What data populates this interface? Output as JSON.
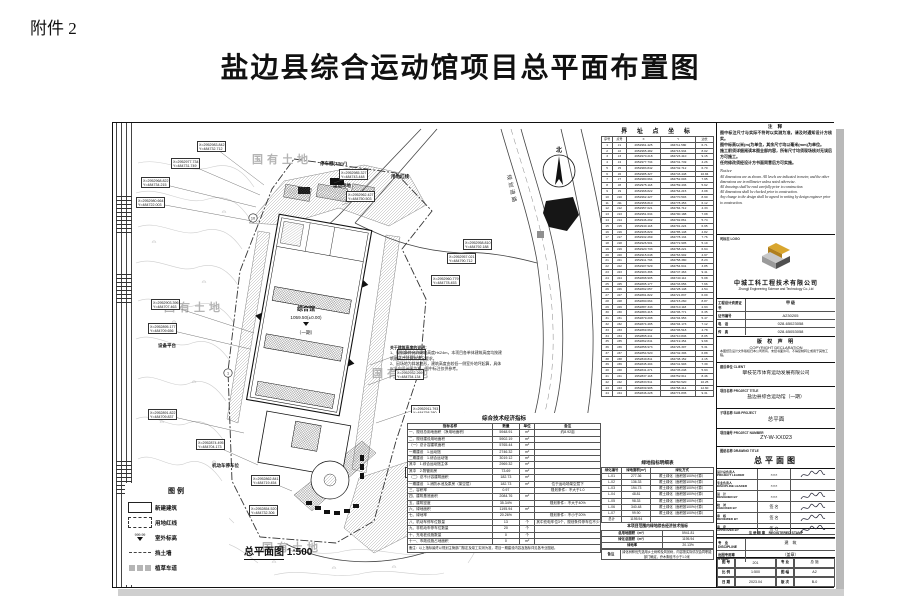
{
  "page": {
    "attachment_label": "附件 2",
    "title": "盐边县综合运动馆项目总平面布置图"
  },
  "drawing": {
    "scale_label": "总平面图",
    "scale_value": "1:500",
    "north_label": "北",
    "road_label": "规划道路",
    "land_labels": [
      "国有土地",
      "国有土地",
      "国有土地",
      "国有土地"
    ],
    "building": {
      "name": "综合馆",
      "elevation": "1059.50(±0.00)",
      "phase": "（一期）"
    },
    "point_markers": [
      "10",
      "1"
    ],
    "labels": {
      "sports_field": "运动场地",
      "red_line": "用地红线",
      "shed": "停车棚(33m²)",
      "platform": "设备平台",
      "parking": "机动车停车位"
    },
    "note_block": {
      "title": "关于建筑高度的说明：",
      "lines": [
        "1、规划条件允许建筑高度H≤24m，本项目各单体建筑高度均按建筑最高点计算并满足要求。",
        "2、因场地为斜坡地形，建筑高度由较低一侧室外地坪起算，具体以竖向设计图为准，图中标注仅供参考。"
      ]
    },
    "callouts": [
      {
        "x": "X=2952983.842",
        "y": "Y=484732.712"
      },
      {
        "x": "X=2952977.734",
        "y": "Y=484731.749"
      },
      {
        "x": "X=2952968.822",
        "y": "Y=484734.215"
      },
      {
        "x": "X=2952980.664",
        "y": "Y=484722.003"
      },
      {
        "x": "X=2952985.327",
        "y": "Y=484743.448"
      },
      {
        "x": "X=2952962.427",
        "y": "Y=484750.503"
      },
      {
        "x": "X=2952958.810",
        "y": "Y=484792.188"
      },
      {
        "x": "X=2952957.021",
        "y": "Y=484790.712"
      },
      {
        "x": "X=2952960.779",
        "y": "Y=484778.453"
      },
      {
        "x": "X=2952935.829",
        "y": "Y=484755.148"
      },
      {
        "x": "X=2952932.269",
        "y": "Y=484754.134"
      },
      {
        "x": "X=2952911.793",
        "y": "Y=484758.380"
      },
      {
        "x": "X=2952907.529",
        "y": "Y=484754.641"
      },
      {
        "x": "X=2952892.057",
        "y": "Y=484748.148"
      },
      {
        "x": "X=2952903.396",
        "y": "Y=484707.463"
      },
      {
        "x": "X=2952895.177",
        "y": "Y=484709.656"
      },
      {
        "x": "X=2952891.822",
        "y": "Y=484709.837"
      },
      {
        "x": "X=2952874.495",
        "y": "Y=484704.173"
      },
      {
        "x": "X=2952862.841",
        "y": "Y=484719.454"
      },
      {
        "x": "X=2952854.520",
        "y": "Y=484732.306"
      },
      {
        "x": "X=2952841.271",
        "y": "Y=484745.248"
      },
      {
        "x": "X=2952833.511",
        "y": "Y=484760.520"
      }
    ]
  },
  "legend": {
    "title": "图例",
    "items": [
      {
        "label": "新建建筑",
        "swatch": "building"
      },
      {
        "label": "用地红线",
        "swatch": "redline"
      },
      {
        "label": "室外标高",
        "swatch": "elevation",
        "sample": "999.99"
      },
      {
        "label": "挡土墙",
        "swatch": "wall"
      },
      {
        "label": "植草车道",
        "swatch": "grass"
      }
    ]
  },
  "boundary_table": {
    "title": "界 址 点 坐 标",
    "headers": [
      "序号",
      "点号",
      "X",
      "Y",
      "边长"
    ],
    "rows": [
      [
        "1",
        "J1",
        "2952961.425",
        "484711.580",
        "6.71"
      ],
      [
        "2",
        "J2",
        "2952965.482",
        "484716.934",
        "8.02"
      ],
      [
        "3",
        "J3",
        "2952970.218",
        "484723.410",
        "9.15"
      ],
      [
        "4",
        "J4",
        "2952977.734",
        "484731.749",
        "4.26"
      ],
      [
        "5",
        "J5",
        "2952983.842",
        "484732.712",
        "6.70"
      ],
      [
        "6",
        "J6",
        "2952985.327",
        "484743.448",
        "10.84"
      ],
      [
        "7",
        "J7",
        "2952980.664",
        "484752.003",
        "7.95"
      ],
      [
        "8",
        "J8",
        "2952975.118",
        "484759.436",
        "5.62"
      ],
      [
        "9",
        "J9",
        "2952968.822",
        "484764.215",
        "3.08"
      ],
      [
        "10",
        "J10",
        "2952962.427",
        "484770.503",
        "8.90"
      ],
      [
        "11",
        "J11",
        "2952958.810",
        "484778.453",
        "6.12"
      ],
      [
        "12",
        "J12",
        "2952957.021",
        "484784.712",
        "4.33"
      ],
      [
        "13",
        "J13",
        "2952951.634",
        "484790.188",
        "7.08"
      ],
      [
        "14",
        "J14",
        "2952946.292",
        "484792.861",
        "5.74"
      ],
      [
        "15",
        "J15",
        "2952940.118",
        "484791.224",
        "6.95"
      ],
      [
        "16",
        "J16",
        "2952935.829",
        "484785.148",
        "4.82"
      ],
      [
        "17",
        "J17",
        "2952932.269",
        "484778.134",
        "7.76"
      ],
      [
        "18",
        "J18",
        "2952926.501",
        "484772.905",
        "5.19"
      ],
      [
        "19",
        "J19",
        "2952920.733",
        "484768.221",
        "6.64"
      ],
      [
        "20",
        "J20",
        "2952915.048",
        "484763.902",
        "4.97"
      ],
      [
        "21",
        "J21",
        "2952911.793",
        "484758.380",
        "8.23"
      ],
      [
        "22",
        "J22",
        "2952907.529",
        "484754.641",
        "3.85"
      ],
      [
        "23",
        "J23",
        "2952903.396",
        "484747.463",
        "9.41"
      ],
      [
        "24",
        "J24",
        "2952898.905",
        "484740.112",
        "5.08"
      ],
      [
        "25",
        "J25",
        "2952895.177",
        "484733.656",
        "7.66"
      ],
      [
        "26",
        "J26",
        "2952892.057",
        "484728.148",
        "4.54"
      ],
      [
        "27",
        "J27",
        "2952891.822",
        "484721.837",
        "6.09"
      ],
      [
        "28",
        "J28",
        "2952890.664",
        "484715.260",
        "8.87"
      ],
      [
        "29",
        "J29",
        "2952887.343",
        "484710.118",
        "2.93"
      ],
      [
        "30",
        "J30",
        "2952883.415",
        "484706.771",
        "6.35"
      ],
      [
        "31",
        "J31",
        "2952879.208",
        "484704.953",
        "5.47"
      ],
      [
        "32",
        "J32",
        "2952874.495",
        "484704.173",
        "7.12"
      ],
      [
        "33",
        "J33",
        "2952869.662",
        "484706.518",
        "4.78"
      ],
      [
        "34",
        "J34",
        "2952865.211",
        "484710.846",
        "8.05"
      ],
      [
        "35",
        "J35",
        "2952862.841",
        "484719.454",
        "9.68"
      ],
      [
        "36",
        "J36",
        "2952858.973",
        "484726.307",
        "5.31"
      ],
      [
        "37",
        "J37",
        "2952854.520",
        "484732.306",
        "6.88"
      ],
      [
        "38",
        "J38",
        "2952849.811",
        "484738.152",
        "4.15"
      ],
      [
        "39",
        "J39",
        "2952845.404",
        "484741.903",
        "7.39"
      ],
      [
        "40",
        "J40",
        "2952841.271",
        "484745.248",
        "5.93"
      ],
      [
        "41",
        "J41",
        "2952837.118",
        "484752.611",
        "8.46"
      ],
      [
        "42",
        "J42",
        "2952833.511",
        "484760.520",
        "10.25"
      ],
      [
        "43",
        "J43",
        "2952839.905",
        "484768.414",
        "12.60"
      ],
      [
        "44",
        "J44",
        "2952846.228",
        "484774.835",
        "9.31"
      ]
    ]
  },
  "eco_table": {
    "title": "综合技术经济指标",
    "headers": [
      "指标名称",
      "数量",
      "单位",
      "备注"
    ],
    "rows": [
      [
        "一、规划总用地面积（净用地面积）",
        "5948.91",
        "m²",
        "约8.92亩"
      ],
      [
        "二、规划建设用地面积",
        "5902.19",
        "m²",
        ""
      ],
      [
        "（一）总计容建筑面积",
        "5765.44",
        "m²",
        ""
      ],
      [
        "一期建设　1.运动馆",
        "2746.32",
        "m²",
        ""
      ],
      [
        "二期建设　1.综合运动馆",
        "3019.12",
        "m²",
        ""
      ],
      [
        "其中　1.综合运动馆主体",
        "2969.32",
        "m²",
        ""
      ],
      [
        "其中　2.物管用房",
        "73.69",
        "m²",
        ""
      ],
      [
        "（二）总不计容建筑面积",
        "182.73",
        "m²",
        ""
      ],
      [
        "一期建设　1.消防水池及泵房（架空层）",
        "182.73",
        "m²",
        "位于运动场架空层下"
      ],
      [
        "三、容积率",
        "0.97",
        "",
        "规划条件：不大于1.0"
      ],
      [
        "四、建筑基底面积",
        "2084.76",
        "m²",
        ""
      ],
      [
        "五、建筑密度",
        "35.34%",
        "",
        "规划条件：不大于40%"
      ],
      [
        "六、绿地面积",
        "1195.94",
        "m²",
        ""
      ],
      [
        "七、绿地率",
        "20.26%",
        "",
        "规划条件：不小于20%"
      ],
      [
        "八、机动车停车位数量",
        "13",
        "个",
        "其中充电车位3个，规划条件停车位不少于13个"
      ],
      [
        "九、非机动车停车位数量",
        "20",
        "个",
        ""
      ],
      [
        "十、充电桩设施数量",
        "0",
        "个",
        ""
      ],
      [
        "十一、市政设施占地面积",
        "0",
        "m²",
        ""
      ]
    ],
    "remark": "备注：以上指标最终以规划主管部门核定及竣工实测为准，项目一期建设内容及指标详见各专业图纸。"
  },
  "green_table": {
    "title": "绿地指标明细表",
    "headers": [
      "绿化编号",
      "绿地面积(m²)",
      "绿化方式"
    ],
    "rows": [
      [
        "L-01",
        "277.36",
        "覆土绿化（面积按100%计算）"
      ],
      [
        "L-02",
        "136.33",
        "覆土绿化（面积按100%计算）"
      ],
      [
        "L-03",
        "194.73",
        "覆土绿化（面积按100%计算）"
      ],
      [
        "L-04",
        "48.81",
        "覆土绿化（面积按100%计算）"
      ],
      [
        "L-05",
        "98.33",
        "覆土绿化（面积按100%计算）"
      ],
      [
        "L-06",
        "340.48",
        "覆土绿化（面积按100%计算）"
      ],
      [
        "L-07",
        "99.90",
        "覆土绿化（面积按100%计算）"
      ],
      [
        "总计",
        "1195.94",
        ""
      ]
    ],
    "summary_title": "本项目范围内绿地综合经济技术指标",
    "summary_rows": [
      [
        "总用地面积（m²）",
        "5941.81"
      ],
      [
        "绿化总面积（m²）",
        "1195.94"
      ],
      [
        "绿地率",
        "20.13%"
      ]
    ],
    "remark_label": "备注",
    "remark": "绿化树种优先选用乡土树种及风景树，内容按实际情况会同职能部门确定，乔木胸径不小于1.0米"
  },
  "titleblock": {
    "notes": {
      "title": "注 释",
      "zh_lines": [
        "图中标注尺寸与实际不符时以实测为准，请及时通知设计方核实。",
        "图中标高以米(m)为单位，其余尺寸均以毫米(mm)为单位。",
        "施工前须详细阅读本图全部内容，所有尺寸均须现场核对无误后方可施工。",
        "任何修改须经设计方书面同意后方可实施。"
      ],
      "en_title": "Notice",
      "en_lines": [
        "All dimensions are as shown. All levels are indicated in meter, and the other dimensions are in millimeter unless noted otherwise.",
        "All drawings shall be read carefully prior to construction.",
        "All dimensions shall be checked prior to construction.",
        "Any change to the design shall be agreed in writing by design engineer prior to construction."
      ]
    },
    "firm": {
      "section_label": "司标志 LOGO",
      "name_zh": "中城工科工程技术有限公司",
      "name_en": "Zhongji Engineering Science and Technology Co.,Ltd",
      "cred_label": "工程设计资质证书",
      "cred_value": "甲 级",
      "rows": [
        [
          "证书编号",
          "A230205"
        ],
        [
          "电　话",
          "028-65023058"
        ],
        [
          "传　真",
          "028-65053058"
        ]
      ]
    },
    "copyright": {
      "title_zh": "版 权 声 明",
      "title_en": "COPYRIGHT DECLARATION",
      "text": "本图纸及设计文件版权归本公司所有，未经书面许可，不得复制转让或用于其他工程。"
    },
    "fields": [
      {
        "label": "建设单位 CLIENT",
        "value": "攀枝花市体育运动发展有限公司"
      },
      {
        "label": "项目名称 PROJECT TITLE",
        "value": "盐边县综合运动馆（一期）"
      },
      {
        "label": "子项名称 SUB PROJECT",
        "value": "总平面"
      },
      {
        "label": "项目编号 PROJECT NUMBER",
        "value": "ZY-W-XX023"
      },
      {
        "label": "图纸名称 DRAWING TITLE",
        "value": "总平面图"
      }
    ],
    "signatures": [
      {
        "role": "设计总负责人",
        "role_en": "PROJECT LEADER",
        "name": "×××",
        "signed": true
      },
      {
        "role": "专业负责人",
        "role_en": "DISCIPLINE LEADER",
        "name": "×××",
        "signed": false
      },
      {
        "role": "设　计",
        "role_en": "DESIGNED BY",
        "name": "×××",
        "signed": true
      },
      {
        "role": "校　对",
        "role_en": "CHECKED BY",
        "name": "签 名",
        "signed": true
      },
      {
        "role": "审　核",
        "role_en": "REVIEWED BY",
        "name": "签 名",
        "signed": true
      },
      {
        "role": "审　定",
        "role_en": "APPROVED BY",
        "name": "签 名",
        "signed": true
      }
    ],
    "stamp_row": "注 册 师 章　REGISTERED STAMP",
    "cert_rows": [
      [
        "专　业 DISCIPLINE",
        "建　筑"
      ],
      [
        "出图专用章 STAMP",
        "（盖章）"
      ]
    ],
    "meta": [
      [
        "图 号",
        "201"
      ],
      [
        "专 业",
        "总 施"
      ],
      [
        "比 例",
        "1:500"
      ],
      [
        "图 幅",
        "A2"
      ],
      [
        "日 期",
        "2023.04"
      ],
      [
        "版 次",
        "B-0"
      ]
    ]
  }
}
